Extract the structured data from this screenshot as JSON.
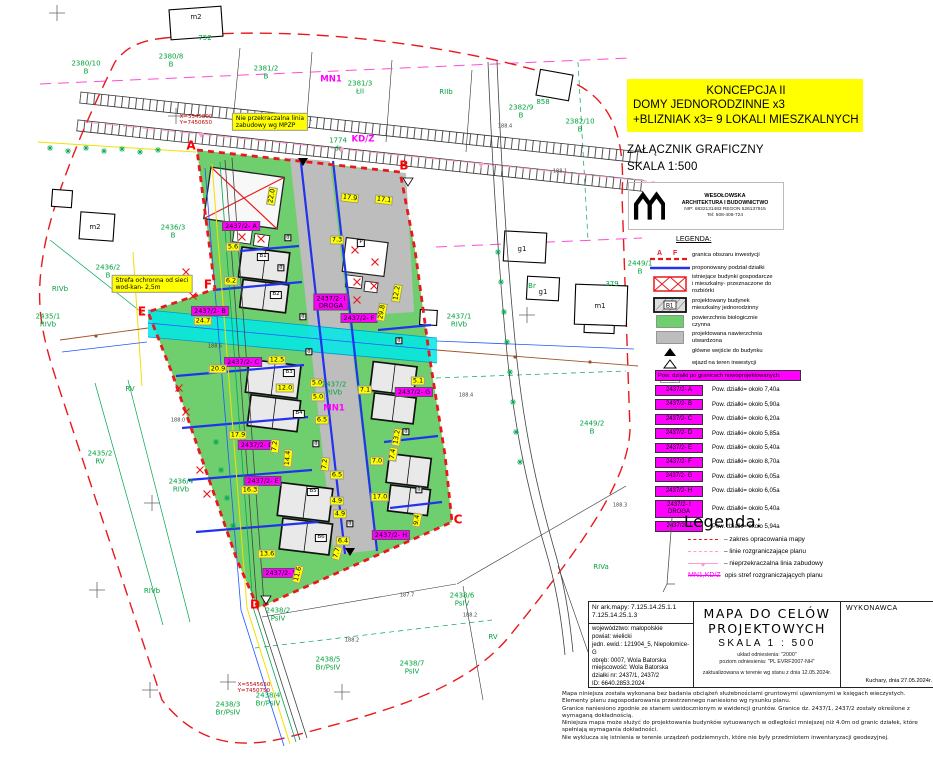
{
  "concept": {
    "line1": "KONCEPCJA II",
    "line2": "DOMY JEDNORODZINNE x3",
    "line3": "+BLIZNIAK x3= 9 LOKALI MIESZKALNYCH"
  },
  "attachment": {
    "title": "ZAŁĄCZNIK GRAFICZNY",
    "scale": "SKALA 1:500"
  },
  "firm": {
    "name": "WESOŁOWSKA",
    "line2": "ARCHITEKTURA I BUDOWNICTWO",
    "nip": "NIP: 6832131483   REGON 526137915",
    "tel": "Tel: 508-408-724"
  },
  "legend": {
    "title": "LEGENDA:",
    "tagA": "A",
    "tagF": "F",
    "projected_tag": "B1",
    "parking_tag": "P",
    "items": [
      {
        "text": "granica obszaru inwestycji"
      },
      {
        "text": "proponowany podział działki"
      },
      {
        "text": "istniejące budynki gospodarcze\ni mieszkalny- przeznaczone do\nrozbiórki"
      },
      {
        "text": "projektowany budynek\nmieszkalny jednorodzinny"
      },
      {
        "text": "powierzchnia biologicznie\nczynna"
      },
      {
        "text": "projektowana nawierzchnia\nutwardzona"
      },
      {
        "text": "główne wejście do budynku"
      },
      {
        "text": "wjazd na teren inwestycji"
      },
      {
        "text": "miejsce postojowe 2,5x5,0 m"
      }
    ]
  },
  "areas": {
    "header": "Pow. działki po granicach nowoprojektowanych:",
    "rows": [
      {
        "label": "2437/2- A",
        "text": "Pow. działki= około 7,40a"
      },
      {
        "label": "2437/2- B",
        "text": "Pow. działki= około 5,90a"
      },
      {
        "label": "2437/2- C",
        "text": "Pow. działki= około 6,20a"
      },
      {
        "label": "2437/2- D",
        "text": "Pow. działki= około 5,85a"
      },
      {
        "label": "2437/2- E",
        "text": "Pow. działki= około 5,40a"
      },
      {
        "label": "2437/2- F",
        "text": "Pow. działki= około 8,70a"
      },
      {
        "label": "2437/2- G",
        "text": "Pow. działki= około 6,05a"
      },
      {
        "label": "2437/2- H",
        "text": "Pow. działki= około 6,05a"
      },
      {
        "label": "2437/2- I\nDROGA",
        "text": "Pow. działki= około 5,40a"
      },
      {
        "label": "2437/2- J",
        "text": "Pow. działki= około 5,94a"
      }
    ]
  },
  "legend2": {
    "title": "Legenda:",
    "items": [
      {
        "text": "– zakres opracowania mapy"
      },
      {
        "text": "– linie rozgraniczające planu"
      },
      {
        "text": "– nieprzekraczalna linia zabudowy"
      }
    ],
    "zone_label": "MN1,KD/Z",
    "zone_text": "opis stref rozgraniczających planu"
  },
  "titleblock": {
    "map_no_label": "Nr ark.mapy:",
    "map_no": "7.125.14.25.1.1\n7.125.14.25.1.3",
    "address": "województwo: małopolskie\npowiat: wielicki\njedn. ewid.: 121904_5, Niepołomice-G\nobręb: 0007, Wola Batorska\nmiejscowość: Wola Batorska\ndziałki nr: 2437/1, 2437/2\nID: 6640.2853.2024",
    "title1": "MAPA DO CELÓW",
    "title2": "PROJEKTOWYCH",
    "scale": "SKALA 1 : 500",
    "ref1": "układ odniesienia: \"2000\"",
    "ref2": "poziom odniesienia: \"PL EVRF2007-NH\"",
    "updated": "zaktualizowana w terenie wg stanu z dnia 12.05.2024r.",
    "contractor": "WYKONAWCA",
    "place_date": "Kuchary, dnia 27.05.2024r."
  },
  "disclaimer": [
    "Mapa niniejsza została wykonana bez badania obciążeń służebnościami gruntowymi ujawnionymi w księgach wieczystych.",
    "Elementy planu zagospodarowania przestrzennego naniesiono wg rysunku planu.",
    "Granice naniesiono zgodnie ze stanem uwidocznionym w ewidencji gruntów. Granice dz. 2437/1, 2437/2 zostały określone z wymaganą dokładnością.",
    "Niniejsza mapa może służyć do projektowania budynków sytuowanych w odległości mniejszej niż 4.0m od granic działek, które spełniają wymagania dokładności.",
    "Nie wyklucza się istnienia w terenie urządzeń podziemnych, które nie były przedmiotem inwentaryzacji geodezyjnej."
  ],
  "map": {
    "colors": {
      "site_green": "#6FCF6F",
      "road_gray": "#BDBDBD",
      "channel_cyan": "#00E8E8",
      "boundary_red": "#E8191C",
      "division_blue": "#2233EE",
      "accent_magenta": "#FF00FF",
      "dim_yellow": "#FFFF00",
      "cad_green": "#00A23C"
    },
    "labels": [
      {
        "t": "A",
        "x": 191,
        "y": 146,
        "c": "corner"
      },
      {
        "t": "B",
        "x": 404,
        "y": 166,
        "c": "corner"
      },
      {
        "t": "C",
        "x": 458,
        "y": 520,
        "c": "corner"
      },
      {
        "t": "D",
        "x": 255,
        "y": 605,
        "c": "corner"
      },
      {
        "t": "E",
        "x": 142,
        "y": 312,
        "c": "corner"
      },
      {
        "t": "F",
        "x": 208,
        "y": 285,
        "c": "corner"
      },
      {
        "t": "2437/2- A",
        "x": 241,
        "y": 226,
        "c": "plot"
      },
      {
        "t": "2437/2- B",
        "x": 210,
        "y": 311,
        "c": "plot"
      },
      {
        "t": "2437/2- I\nDROGA",
        "x": 331,
        "y": 302,
        "c": "plot"
      },
      {
        "t": "2437/2- F",
        "x": 359,
        "y": 318,
        "c": "plot"
      },
      {
        "t": "2437/2- C",
        "x": 243,
        "y": 362,
        "c": "plot"
      },
      {
        "t": "2437/2- D",
        "x": 257,
        "y": 445,
        "c": "plot"
      },
      {
        "t": "2437/2- E",
        "x": 263,
        "y": 481,
        "c": "plot"
      },
      {
        "t": "2437/2- G",
        "x": 414,
        "y": 392,
        "c": "plot"
      },
      {
        "t": "2437/2- H",
        "x": 391,
        "y": 535,
        "c": "plot"
      },
      {
        "t": "2437/2- J",
        "x": 280,
        "y": 573,
        "c": "plot"
      },
      {
        "t": "22.0",
        "x": 272,
        "y": 196,
        "c": "dim",
        "r": -80
      },
      {
        "t": "17.9",
        "x": 350,
        "y": 198,
        "c": "dim",
        "r": 7
      },
      {
        "t": "17.1",
        "x": 384,
        "y": 200,
        "c": "dim",
        "r": 7
      },
      {
        "t": "5.6",
        "x": 233,
        "y": 247,
        "c": "dim"
      },
      {
        "t": "6.2",
        "x": 231,
        "y": 281,
        "c": "dim"
      },
      {
        "t": "7.3",
        "x": 337,
        "y": 240,
        "c": "dim"
      },
      {
        "t": "24.7",
        "x": 203,
        "y": 321,
        "c": "dim"
      },
      {
        "t": "29.8",
        "x": 382,
        "y": 312,
        "c": "dim",
        "r": -80
      },
      {
        "t": "12.2",
        "x": 397,
        "y": 293,
        "c": "dim",
        "r": -80
      },
      {
        "t": "20.9",
        "x": 218,
        "y": 369,
        "c": "dim"
      },
      {
        "t": "12.5",
        "x": 277,
        "y": 360,
        "c": "dim"
      },
      {
        "t": "12.0",
        "x": 285,
        "y": 388,
        "c": "dim"
      },
      {
        "t": "5.0",
        "x": 317,
        "y": 383,
        "c": "dim"
      },
      {
        "t": "5.0",
        "x": 318,
        "y": 397,
        "c": "dim"
      },
      {
        "t": "6.5",
        "x": 322,
        "y": 420,
        "c": "dim"
      },
      {
        "t": "7.1",
        "x": 365,
        "y": 390,
        "c": "dim"
      },
      {
        "t": "5.1",
        "x": 418,
        "y": 381,
        "c": "dim"
      },
      {
        "t": "17.9",
        "x": 238,
        "y": 435,
        "c": "dim"
      },
      {
        "t": "7.2",
        "x": 275,
        "y": 446,
        "c": "dim",
        "r": -85
      },
      {
        "t": "14.4",
        "x": 288,
        "y": 458,
        "c": "dim",
        "r": -85
      },
      {
        "t": "7.2",
        "x": 325,
        "y": 464,
        "c": "dim",
        "r": -85
      },
      {
        "t": "16.3",
        "x": 250,
        "y": 490,
        "c": "dim"
      },
      {
        "t": "6.5",
        "x": 337,
        "y": 475,
        "c": "dim"
      },
      {
        "t": "7.0",
        "x": 377,
        "y": 461,
        "c": "dim"
      },
      {
        "t": "13.2",
        "x": 397,
        "y": 437,
        "c": "dim",
        "r": -80
      },
      {
        "t": "7.4",
        "x": 393,
        "y": 454,
        "c": "dim",
        "r": -80
      },
      {
        "t": "17.0",
        "x": 380,
        "y": 497,
        "c": "dim"
      },
      {
        "t": "4.9",
        "x": 337,
        "y": 501,
        "c": "dim"
      },
      {
        "t": "4.9",
        "x": 340,
        "y": 514,
        "c": "dim"
      },
      {
        "t": "6.4",
        "x": 343,
        "y": 541,
        "c": "dim"
      },
      {
        "t": "9.4",
        "x": 417,
        "y": 520,
        "c": "dim",
        "r": -80
      },
      {
        "t": "13.6",
        "x": 267,
        "y": 554,
        "c": "dim"
      },
      {
        "t": "11.6",
        "x": 298,
        "y": 574,
        "c": "dim",
        "r": -75
      },
      {
        "t": "7.7",
        "x": 337,
        "y": 553,
        "c": "dim",
        "r": -75
      },
      {
        "t": "2380/10\nB",
        "x": 86,
        "y": 68,
        "c": "gcad"
      },
      {
        "t": "2380/8\nB",
        "x": 171,
        "y": 61,
        "c": "gcad"
      },
      {
        "t": "2381/2\nB",
        "x": 266,
        "y": 73,
        "c": "gcad"
      },
      {
        "t": "2381/3\nŁII",
        "x": 360,
        "y": 88,
        "c": "gcad"
      },
      {
        "t": "RIIb",
        "x": 446,
        "y": 93,
        "c": "gcad"
      },
      {
        "t": "2382/9\nB",
        "x": 521,
        "y": 112,
        "c": "gcad"
      },
      {
        "t": "2382/10\nB",
        "x": 580,
        "y": 126,
        "c": "gcad"
      },
      {
        "t": "752",
        "x": 205,
        "y": 39,
        "c": "gcad"
      },
      {
        "t": "858",
        "x": 543,
        "y": 103,
        "c": "gcad"
      },
      {
        "t": "1774\ndr",
        "x": 338,
        "y": 145,
        "c": "gcad"
      },
      {
        "t": "2436/3\nB",
        "x": 173,
        "y": 232,
        "c": "gcad"
      },
      {
        "t": "2436/2\nB",
        "x": 108,
        "y": 272,
        "c": "gcad"
      },
      {
        "t": "RIVb",
        "x": 60,
        "y": 290,
        "c": "gcad"
      },
      {
        "t": "2435/1\nRIVb",
        "x": 48,
        "y": 321,
        "c": "gcad"
      },
      {
        "t": "2437/1\nRIVb",
        "x": 459,
        "y": 321,
        "c": "gcad"
      },
      {
        "t": "Br",
        "x": 532,
        "y": 287,
        "c": "gcad"
      },
      {
        "t": "2449/1\nB",
        "x": 640,
        "y": 268,
        "c": "gcad"
      },
      {
        "t": "2449/2\nB",
        "x": 592,
        "y": 428,
        "c": "gcad"
      },
      {
        "t": "RV",
        "x": 130,
        "y": 390,
        "c": "gcad"
      },
      {
        "t": "2435/2\nRV",
        "x": 100,
        "y": 458,
        "c": "gcad"
      },
      {
        "t": "2436/4\nRIVb",
        "x": 181,
        "y": 486,
        "c": "gcad"
      },
      {
        "t": "RIVb",
        "x": 152,
        "y": 592,
        "c": "gcad"
      },
      {
        "t": "RIVa",
        "x": 601,
        "y": 568,
        "c": "gcad"
      },
      {
        "t": "2438/6\nPsIV",
        "x": 462,
        "y": 600,
        "c": "gcad"
      },
      {
        "t": "2438/7\nPsIV",
        "x": 412,
        "y": 668,
        "c": "gcad"
      },
      {
        "t": "2438/2\nPsIV",
        "x": 278,
        "y": 615,
        "c": "gcad"
      },
      {
        "t": "2438/5\nBr/PsIV",
        "x": 328,
        "y": 664,
        "c": "gcad"
      },
      {
        "t": "2438/4\nBr/PsIV",
        "x": 268,
        "y": 700,
        "c": "gcad"
      },
      {
        "t": "2438/3\nBr/PsIV",
        "x": 228,
        "y": 709,
        "c": "gcad"
      },
      {
        "t": "RV",
        "x": 493,
        "y": 638,
        "c": "gcad"
      },
      {
        "t": "2437/2\nRIVb",
        "x": 334,
        "y": 389,
        "c": "gcad"
      },
      {
        "t": "379",
        "x": 612,
        "y": 285,
        "c": "gcad"
      },
      {
        "t": "MN1",
        "x": 331,
        "y": 80,
        "c": "zone"
      },
      {
        "t": "KD/Z",
        "x": 363,
        "y": 140,
        "c": "zone"
      },
      {
        "t": "MN1",
        "x": 334,
        "y": 409,
        "c": "zone"
      },
      {
        "t": "m2",
        "x": 196,
        "y": 18,
        "c": "bcad"
      },
      {
        "t": "m2",
        "x": 95,
        "y": 228,
        "c": "bcad"
      },
      {
        "t": "g1",
        "x": 522,
        "y": 250,
        "c": "bcad"
      },
      {
        "t": "g1",
        "x": 543,
        "y": 293,
        "c": "bcad"
      },
      {
        "t": "m1",
        "x": 600,
        "y": 307,
        "c": "bcad"
      },
      {
        "t": "188.1",
        "x": 305,
        "y": 120,
        "c": "elev"
      },
      {
        "t": "188.4",
        "x": 505,
        "y": 127,
        "c": "elev"
      },
      {
        "t": "188.1",
        "x": 560,
        "y": 172,
        "c": "elev"
      },
      {
        "t": "188.6",
        "x": 215,
        "y": 347,
        "c": "elev"
      },
      {
        "t": "188.0",
        "x": 178,
        "y": 421,
        "c": "elev"
      },
      {
        "t": "188.4",
        "x": 466,
        "y": 396,
        "c": "elev"
      },
      {
        "t": "188.2",
        "x": 470,
        "y": 616,
        "c": "elev"
      },
      {
        "t": "188.3",
        "x": 620,
        "y": 506,
        "c": "elev"
      },
      {
        "t": "188.2",
        "x": 352,
        "y": 641,
        "c": "elev"
      },
      {
        "t": "187.7",
        "x": 407,
        "y": 596,
        "c": "elev"
      },
      {
        "t": "X=5545800\nY=7450650",
        "x": 196,
        "y": 121,
        "c": "rcoord"
      },
      {
        "t": "X=5545650\nY=7450750",
        "x": 254,
        "y": 689,
        "c": "rcoord"
      },
      {
        "t": "Nie przekraczalna linia\nzabudowy wg MPZP",
        "x": 270,
        "y": 122,
        "c": "note"
      },
      {
        "t": "Strefa ochronna od sieci\nwod-kan- 2,5m",
        "x": 152,
        "y": 284,
        "c": "note"
      },
      {
        "t": "B1",
        "x": 263,
        "y": 257,
        "c": "bld"
      },
      {
        "t": "B2",
        "x": 276,
        "y": 295,
        "c": "bld"
      },
      {
        "t": "B3",
        "x": 289,
        "y": 373,
        "c": "bld"
      },
      {
        "t": "B4",
        "x": 299,
        "y": 414,
        "c": "bld"
      },
      {
        "t": "B5",
        "x": 313,
        "y": 492,
        "c": "bld"
      },
      {
        "t": "B6",
        "x": 321,
        "y": 538,
        "c": "bld"
      },
      {
        "t": "P",
        "x": 361,
        "y": 243,
        "c": "bld"
      },
      {
        "t": "d",
        "x": 288,
        "y": 238,
        "c": "bldd"
      },
      {
        "t": "d",
        "x": 281,
        "y": 268,
        "c": "bldd"
      },
      {
        "t": "d",
        "x": 303,
        "y": 317,
        "c": "bldd"
      },
      {
        "t": "d",
        "x": 309,
        "y": 352,
        "c": "bldd"
      },
      {
        "t": "d",
        "x": 316,
        "y": 444,
        "c": "bldd"
      },
      {
        "t": "d",
        "x": 350,
        "y": 524,
        "c": "bldd"
      },
      {
        "t": "d",
        "x": 399,
        "y": 341,
        "c": "bldd"
      },
      {
        "t": "d",
        "x": 406,
        "y": 432,
        "c": "bldd"
      },
      {
        "t": "d",
        "x": 419,
        "y": 490,
        "c": "bldd"
      }
    ]
  }
}
